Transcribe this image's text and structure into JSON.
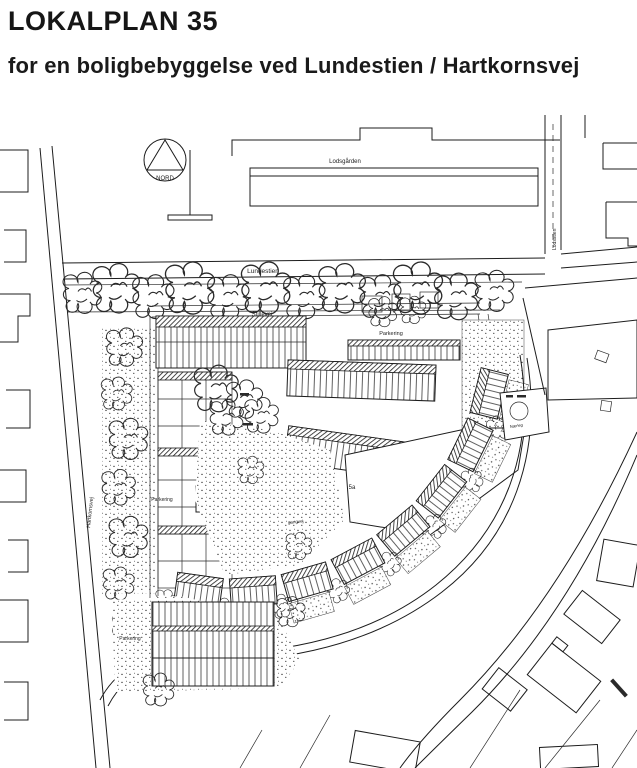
{
  "document": {
    "title": "LOKALPLAN 35",
    "subtitle": "for en boligbebyggelse  ved Lundestien /  Hartkornsvej"
  },
  "map": {
    "compass_label": "NORD",
    "streets": {
      "lundestien": "Lundestien",
      "hartkornsvej": "Hartkornsvej",
      "stillevej": "Stillevej",
      "lodsstien": "Lodsstien"
    },
    "places": {
      "lodsgaarden": "Lodsgården",
      "faelleshus": "Fælleshus",
      "parcel_5a": "5a",
      "gangvej": "gangvej",
      "naerleg": "Nærleg",
      "parkering_north": "Parkering",
      "parkering_west": "Parkering",
      "parkering_south": "Parkering"
    }
  },
  "colors": {
    "ink": "#1c1c1c",
    "paper": "#ffffff"
  }
}
